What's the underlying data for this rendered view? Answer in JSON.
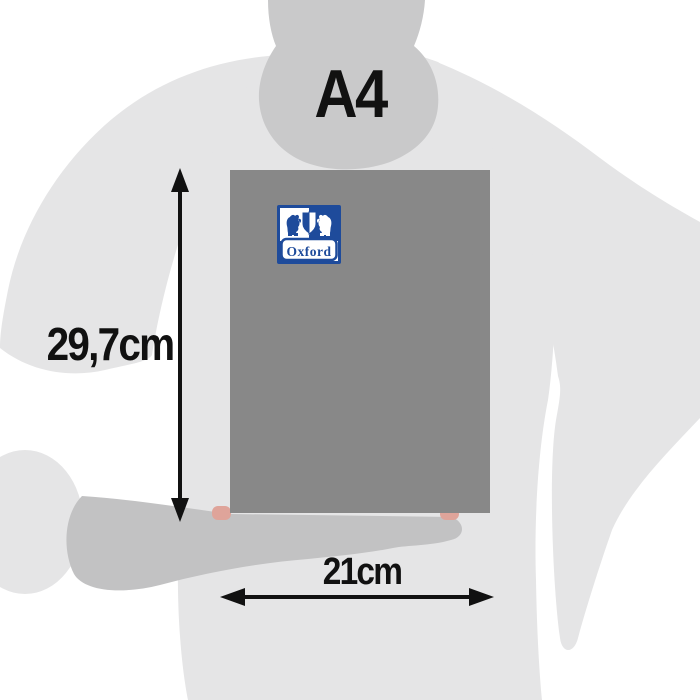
{
  "diagram": {
    "format_label": "A4",
    "height_label": "29,7cm",
    "width_label": "21cm"
  },
  "product": {
    "kind": "notebook cover held by person silhouette",
    "brand_logo_text": "Oxford"
  },
  "colors": {
    "background": "#ffffff",
    "silhouette_body": "#e5e5e6",
    "silhouette_head": "#c9c9ca",
    "silhouette_hand": "#c2c2c3",
    "notebook_gray": "#888888",
    "logo_blue": "#1e4b9b",
    "annotation_black": "#111111",
    "skin_accent": "#dfa49a"
  }
}
